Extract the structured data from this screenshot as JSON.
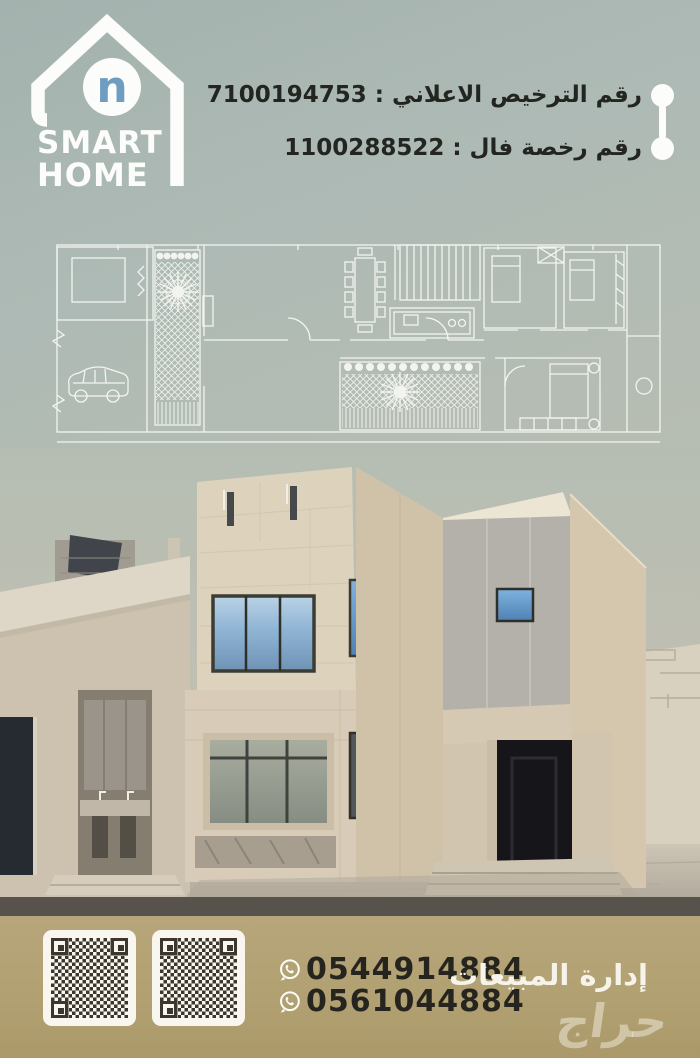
{
  "poster": {
    "brand": {
      "name_line1": "SMART",
      "name_line2": "HOME",
      "monogram": "n"
    },
    "licenses": {
      "ad_license": "رقم الترخيص الاعلاني : 7100194753",
      "fal_license": "رقم رخصة فال : 1100288522"
    },
    "footer": {
      "phone1": "0544914884",
      "phone2": "0561044884",
      "department": "إدارة المبيعات",
      "watermark": "حراج"
    },
    "icons": {
      "logo_house": "house-logo-icon",
      "connector": "timeline-connector-icon",
      "whatsapp": "whatsapp-icon",
      "qr": "qr-code"
    },
    "colors": {
      "sage_background": "#aebab4",
      "footer_tan": "#b1a071",
      "logo_blue": "#6f9dc2",
      "text_dark": "#26241e",
      "white": "#fcfdfa"
    }
  }
}
